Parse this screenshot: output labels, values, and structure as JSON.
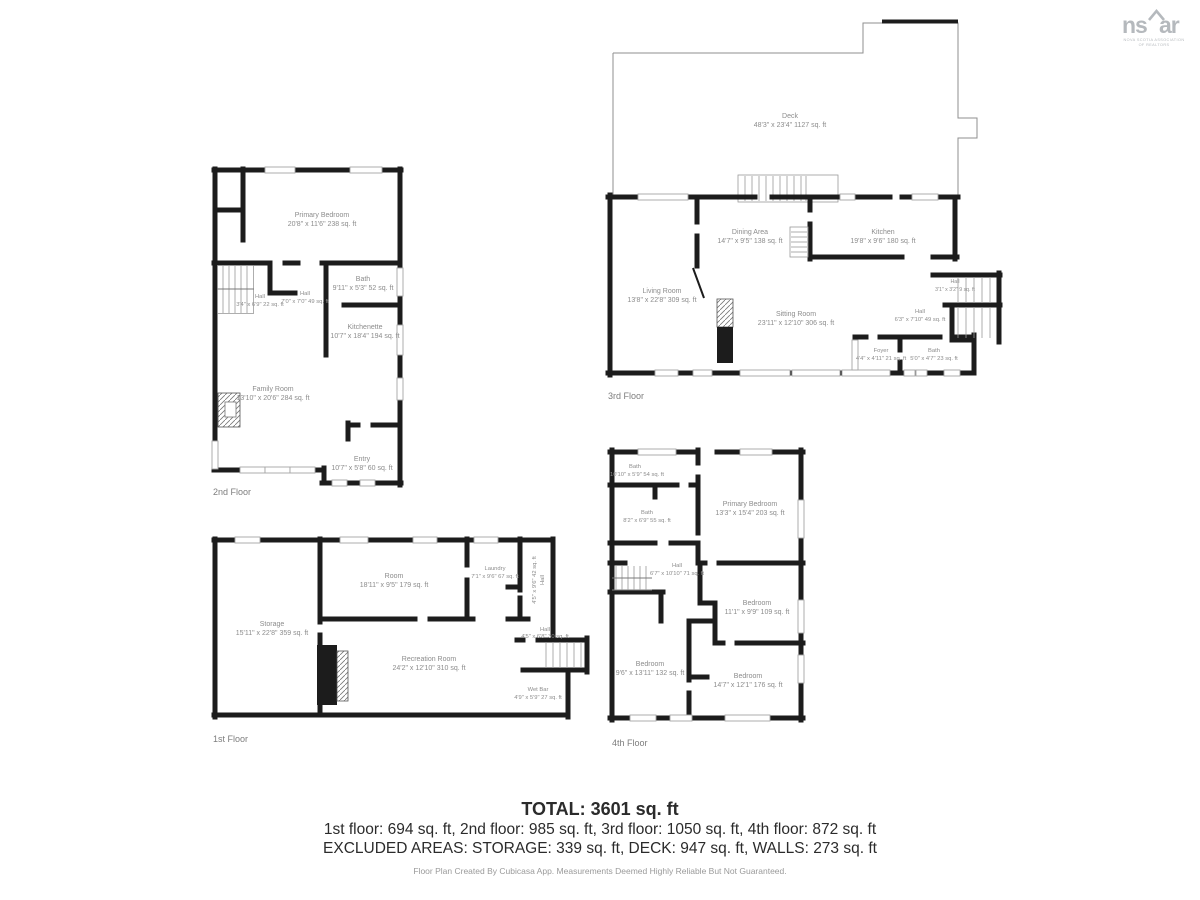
{
  "logo": {
    "brand_left": "ns",
    "brand_right": "ar",
    "tagline_line1": "NOVA SCOTIA ASSOCIATION",
    "tagline_line2": "OF REALTORS"
  },
  "floors": {
    "first": {
      "label": "1st Floor",
      "rooms": {
        "storage": {
          "name": "Storage",
          "dims": "15'11\" x 22'8\" 359 sq. ft"
        },
        "room": {
          "name": "Room",
          "dims": "18'11\" x 9'5\" 179 sq. ft"
        },
        "laundry": {
          "name": "Laundry",
          "dims": "7'1\" x 9'6\" 67 sq. ft"
        },
        "hall_vertical": {
          "name": "Hall",
          "dims": "4'5\" x 9'6\" 42 sq. ft"
        },
        "hall": {
          "name": "Hall",
          "dims": "4'5\" x 6'8\" 30 sq. ft"
        },
        "recreation_room": {
          "name": "Recreation Room",
          "dims": "24'2\" x 12'10\" 310 sq. ft"
        },
        "wet_bar": {
          "name": "Wet Bar",
          "dims": "4'9\" x 5'9\" 27 sq. ft"
        }
      }
    },
    "second": {
      "label": "2nd Floor",
      "rooms": {
        "primary_bedroom": {
          "name": "Primary Bedroom",
          "dims": "20'8\" x 11'6\" 238 sq. ft"
        },
        "bath": {
          "name": "Bath",
          "dims": "9'11\" x 5'3\" 52 sq. ft"
        },
        "hall_a": {
          "name": "Hall",
          "dims": "3'4\" x 6'9\" 22 sq. ft"
        },
        "hall_b": {
          "name": "Hall",
          "dims": "7'0\" x 7'0\" 49 sq. ft"
        },
        "kitchenette": {
          "name": "Kitchenette",
          "dims": "10'7\" x 18'4\" 194 sq. ft"
        },
        "family_room": {
          "name": "Family Room",
          "dims": "13'10\" x 20'6\" 284 sq. ft"
        },
        "entry": {
          "name": "Entry",
          "dims": "10'7\" x 5'8\" 60 sq. ft"
        }
      }
    },
    "third": {
      "label": "3rd Floor",
      "rooms": {
        "deck": {
          "name": "Deck",
          "dims": "48'3\" x 23'4\" 1127 sq. ft"
        },
        "living_room": {
          "name": "Living Room",
          "dims": "13'8\" x 22'8\" 309 sq. ft"
        },
        "dining_area": {
          "name": "Dining Area",
          "dims": "14'7\" x 9'5\" 138 sq. ft"
        },
        "kitchen": {
          "name": "Kitchen",
          "dims": "19'8\" x 9'6\" 180 sq. ft"
        },
        "sitting_room": {
          "name": "Sitting Room",
          "dims": "23'11\" x 12'10\" 306 sq. ft"
        },
        "hall_small": {
          "name": "Hall",
          "dims": "3'1\" x 3'2\" 9 sq. ft"
        },
        "hall": {
          "name": "Hall",
          "dims": "6'3\" x 7'10\" 49 sq. ft"
        },
        "foyer": {
          "name": "Foyer",
          "dims": "4'4\" x 4'11\" 21 sq. ft"
        },
        "bath": {
          "name": "Bath",
          "dims": "5'0\" x 4'7\" 23 sq. ft"
        }
      }
    },
    "fourth": {
      "label": "4th Floor",
      "rooms": {
        "bath_a": {
          "name": "Bath",
          "dims": "10'10\" x 5'9\" 54 sq. ft"
        },
        "bath_b": {
          "name": "Bath",
          "dims": "8'2\" x 6'9\" 55 sq. ft"
        },
        "primary_bedroom": {
          "name": "Primary Bedroom",
          "dims": "13'3\" x 15'4\" 203 sq. ft"
        },
        "hall": {
          "name": "Hall",
          "dims": "6'7\" x 10'10\" 71 sq. ft"
        },
        "bedroom_a": {
          "name": "Bedroom",
          "dims": "11'1\" x 9'9\" 109 sq. ft"
        },
        "bedroom_b": {
          "name": "Bedroom",
          "dims": "9'6\" x 13'11\" 132 sq. ft"
        },
        "bedroom_c": {
          "name": "Bedroom",
          "dims": "14'7\" x 12'1\" 176 sq. ft"
        }
      }
    }
  },
  "summary": {
    "total": "TOTAL: 3601 sq. ft",
    "floors_line": "1st floor: 694 sq. ft, 2nd floor: 985 sq. ft, 3rd floor: 1050 sq. ft, 4th floor: 872 sq. ft",
    "excluded_line": "EXCLUDED AREAS: STORAGE: 339 sq. ft, DECK: 947 sq. ft, WALLS: 273 sq. ft"
  },
  "footer": "Floor Plan Created By Cubicasa App. Measurements Deemed Highly Reliable But Not Guaranteed."
}
